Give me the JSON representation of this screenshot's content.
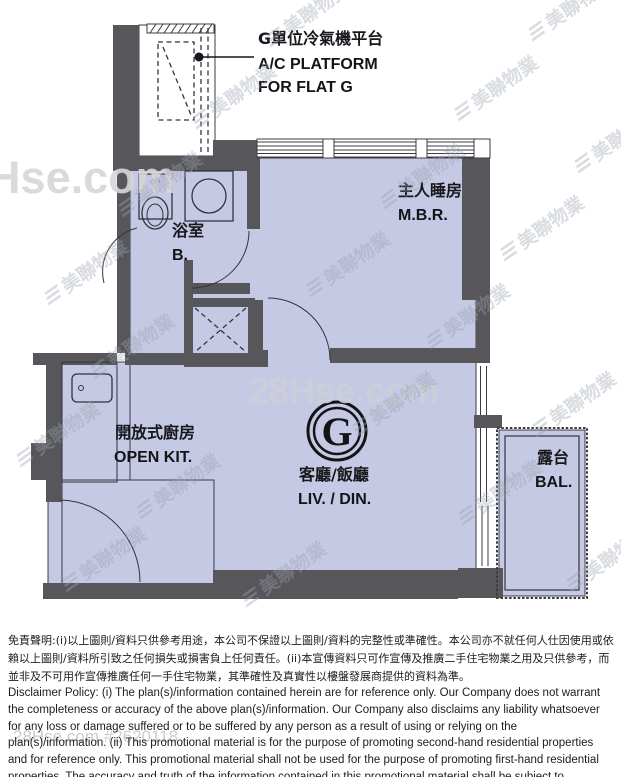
{
  "plan": {
    "callout": {
      "zh": "G單位冷氣機平台",
      "en1": "A/C PLATFORM",
      "en2": "FOR FLAT G"
    },
    "rooms": {
      "master_bedroom": {
        "zh": "主人睡房",
        "en": "M.B.R."
      },
      "bathroom": {
        "zh": "浴室",
        "en": "B."
      },
      "open_kitchen": {
        "zh": "開放式廚房",
        "en": "OPEN KIT."
      },
      "living_dining": {
        "zh": "客廳/飯廳",
        "en": "LIV. / DIN.",
        "flat_badge": "G"
      },
      "balcony": {
        "zh": "露台",
        "en": "BAL."
      }
    }
  },
  "watermarks": {
    "brand": "美聯物業",
    "site": "28Hse.com",
    "site_ref": "28Hse.com #2620118"
  },
  "disclaimer": {
    "zh": "免責聲明:(i)以上圖則/資料只供參考用途，本公司不保證以上圖則/資料的完整性或準確性。本公司亦不就任何人仕因使用或依賴以上圖則/資料所引致之任何損失或損害負上任何責任。(ii)本宣傳資料只可作宣傳及推廣二手住宅物業之用及只供參考，而並非及不可用作宣傳推廣任何一手住宅物業，其準確性及真實性以樓盤發展商提供的資料為準。",
    "en": "Disclaimer Policy: (i) The plan(s)/information contained herein are for reference only. Our Company does not warrant the completeness or accuracy of the above plan(s)/information. Our Company also disclaims any liability whatsoever for any loss or damage suffered or to be suffered by any person as a result of using or relying on the plan(s)/information. (ii) This promotional material is for the purpose of promoting second-hand residential properties and for reference only. This promotional material shall not be used for the purpose of promoting first-hand residential properties. The accuracy and truth of the information contained in this promotional material shall be subject to information provided by the developers."
  },
  "colors": {
    "room_fill": "#c6c9e3",
    "wall": "#57575b"
  }
}
